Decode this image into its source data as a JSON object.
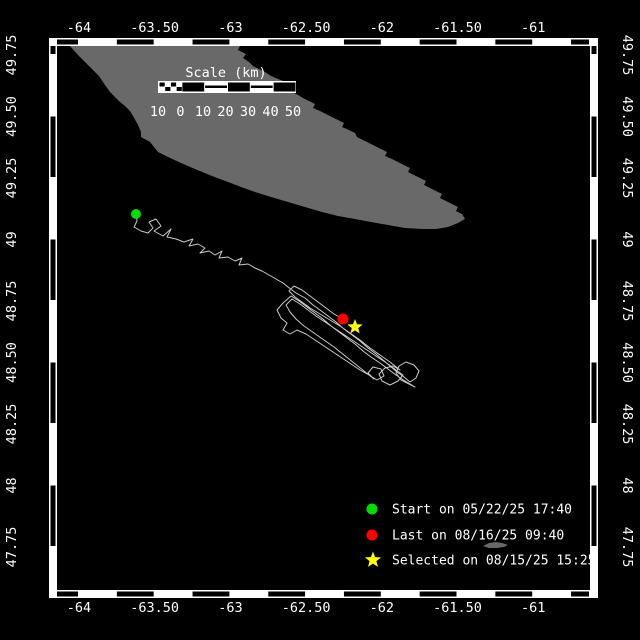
{
  "map": {
    "axes": {
      "lon_ticks": [
        "-64",
        "-63.50",
        "-63",
        "-62.50",
        "-62",
        "-61.50",
        "-61"
      ],
      "lat_ticks": [
        "49.75",
        "49.50",
        "49.25",
        "49",
        "48.75",
        "48.50",
        "48.25",
        "48",
        "47.75"
      ]
    },
    "scale_bar": {
      "title": "Scale (km)",
      "tick_labels": [
        "10",
        "0",
        "10",
        "20",
        "30",
        "40",
        "50"
      ]
    },
    "legend": [
      {
        "marker": "circle",
        "color": "#00dd00",
        "label": "Start on 05/22/25 17:40"
      },
      {
        "marker": "circle",
        "color": "#ff0000",
        "label": "Last on 08/16/25 09:40"
      },
      {
        "marker": "star",
        "color": "#ffff00",
        "label": "Selected on 08/15/25 15:25"
      }
    ],
    "markers": {
      "start": {
        "x": 136,
        "y": 214,
        "color": "#00dd00"
      },
      "last": {
        "x": 343,
        "y": 319,
        "color": "#ff0000"
      },
      "selected": {
        "x": 355,
        "y": 327,
        "color": "#ffff00"
      }
    },
    "colors": {
      "background": "#000000",
      "land": "#696969",
      "track": "#c9c9c9",
      "frame": "#ffffff",
      "text": "#ffffff"
    },
    "land_polygons": [
      [
        [
          70,
          46
        ],
        [
          78,
          55
        ],
        [
          85,
          62
        ],
        [
          92,
          69
        ],
        [
          99,
          76
        ],
        [
          105,
          85
        ],
        [
          110,
          92
        ],
        [
          115,
          97
        ],
        [
          120,
          102
        ],
        [
          125,
          106
        ],
        [
          130,
          111
        ],
        [
          133,
          116
        ],
        [
          138,
          125
        ],
        [
          141,
          132
        ],
        [
          141,
          137
        ],
        [
          150,
          142
        ],
        [
          154,
          147
        ],
        [
          158,
          152
        ],
        [
          168,
          157
        ],
        [
          181,
          163
        ],
        [
          195,
          169
        ],
        [
          212,
          176
        ],
        [
          228,
          182
        ],
        [
          241,
          187
        ],
        [
          255,
          192
        ],
        [
          271,
          197
        ],
        [
          288,
          202
        ],
        [
          305,
          207
        ],
        [
          322,
          212
        ],
        [
          338,
          216
        ],
        [
          355,
          219
        ],
        [
          371,
          222
        ],
        [
          388,
          225
        ],
        [
          405,
          228
        ],
        [
          422,
          229
        ],
        [
          436,
          229
        ],
        [
          448,
          227
        ],
        [
          458,
          223
        ],
        [
          465,
          219
        ],
        [
          462,
          214
        ],
        [
          456,
          211
        ],
        [
          458,
          207
        ],
        [
          452,
          204
        ],
        [
          446,
          201
        ],
        [
          440,
          198
        ],
        [
          442,
          194
        ],
        [
          436,
          191
        ],
        [
          430,
          188
        ],
        [
          424,
          185
        ],
        [
          426,
          181
        ],
        [
          420,
          178
        ],
        [
          414,
          175
        ],
        [
          408,
          172
        ],
        [
          410,
          168
        ],
        [
          404,
          165
        ],
        [
          398,
          162
        ],
        [
          392,
          159
        ],
        [
          385,
          156
        ],
        [
          387,
          152
        ],
        [
          381,
          149
        ],
        [
          375,
          146
        ],
        [
          369,
          143
        ],
        [
          363,
          140
        ],
        [
          357,
          137
        ],
        [
          355,
          133
        ],
        [
          349,
          130
        ],
        [
          342,
          127
        ],
        [
          344,
          123
        ],
        [
          338,
          120
        ],
        [
          332,
          117
        ],
        [
          326,
          114
        ],
        [
          320,
          111
        ],
        [
          313,
          108
        ],
        [
          315,
          104
        ],
        [
          309,
          101
        ],
        [
          303,
          98
        ],
        [
          298,
          95
        ],
        [
          292,
          92
        ],
        [
          286,
          89
        ],
        [
          280,
          85
        ],
        [
          286,
          82
        ],
        [
          278,
          79
        ],
        [
          271,
          76
        ],
        [
          265,
          72
        ],
        [
          259,
          69
        ],
        [
          253,
          66
        ],
        [
          249,
          62
        ],
        [
          243,
          58
        ],
        [
          246,
          54
        ],
        [
          238,
          50
        ],
        [
          240,
          46
        ]
      ],
      [
        [
          483,
          546
        ],
        [
          489,
          543
        ],
        [
          496,
          542
        ],
        [
          502,
          543
        ],
        [
          508,
          545
        ],
        [
          504,
          547
        ],
        [
          497,
          548
        ],
        [
          489,
          548
        ]
      ]
    ],
    "track": [
      [
        136,
        214
      ],
      [
        137,
        221
      ],
      [
        134,
        227
      ],
      [
        141,
        231
      ],
      [
        148,
        233
      ],
      [
        153,
        228
      ],
      [
        149,
        222
      ],
      [
        156,
        219
      ],
      [
        161,
        226
      ],
      [
        154,
        231
      ],
      [
        163,
        236
      ],
      [
        171,
        229
      ],
      [
        167,
        237
      ],
      [
        176,
        239
      ],
      [
        184,
        242
      ],
      [
        193,
        239
      ],
      [
        189,
        246
      ],
      [
        198,
        244
      ],
      [
        205,
        248
      ],
      [
        200,
        253
      ],
      [
        209,
        251
      ],
      [
        215,
        255
      ],
      [
        222,
        251
      ],
      [
        219,
        258
      ],
      [
        228,
        257
      ],
      [
        235,
        261
      ],
      [
        242,
        258
      ],
      [
        239,
        265
      ],
      [
        248,
        264
      ],
      [
        255,
        268
      ],
      [
        262,
        271
      ],
      [
        269,
        275
      ],
      [
        276,
        279
      ],
      [
        283,
        283
      ],
      [
        288,
        287
      ],
      [
        296,
        293
      ],
      [
        305,
        298
      ],
      [
        313,
        305
      ],
      [
        320,
        310
      ],
      [
        328,
        316
      ],
      [
        336,
        322
      ],
      [
        344,
        329
      ],
      [
        352,
        335
      ],
      [
        360,
        341
      ],
      [
        368,
        348
      ],
      [
        376,
        354
      ],
      [
        383,
        360
      ],
      [
        390,
        366
      ],
      [
        397,
        372
      ],
      [
        404,
        377
      ],
      [
        410,
        382
      ],
      [
        416,
        378
      ],
      [
        419,
        371
      ],
      [
        414,
        365
      ],
      [
        406,
        362
      ],
      [
        399,
        366
      ],
      [
        396,
        373
      ],
      [
        401,
        380
      ],
      [
        409,
        384
      ],
      [
        415,
        387
      ],
      [
        405,
        381
      ],
      [
        396,
        375
      ],
      [
        388,
        369
      ],
      [
        380,
        363
      ],
      [
        371,
        357
      ],
      [
        363,
        351
      ],
      [
        355,
        344
      ],
      [
        347,
        338
      ],
      [
        339,
        332
      ],
      [
        331,
        326
      ],
      [
        323,
        319
      ],
      [
        315,
        313
      ],
      [
        307,
        307
      ],
      [
        299,
        301
      ],
      [
        291,
        296
      ],
      [
        283,
        303
      ],
      [
        277,
        310
      ],
      [
        281,
        318
      ],
      [
        287,
        323
      ],
      [
        283,
        330
      ],
      [
        290,
        334
      ],
      [
        297,
        330
      ],
      [
        306,
        334
      ],
      [
        315,
        340
      ],
      [
        324,
        346
      ],
      [
        333,
        352
      ],
      [
        342,
        358
      ],
      [
        351,
        364
      ],
      [
        360,
        370
      ],
      [
        369,
        375
      ],
      [
        377,
        380
      ],
      [
        384,
        376
      ],
      [
        381,
        369
      ],
      [
        373,
        367
      ],
      [
        368,
        373
      ],
      [
        374,
        379
      ],
      [
        364,
        371
      ],
      [
        354,
        363
      ],
      [
        344,
        355
      ],
      [
        334,
        347
      ],
      [
        324,
        340
      ],
      [
        314,
        333
      ],
      [
        304,
        326
      ],
      [
        296,
        319
      ],
      [
        290,
        312
      ],
      [
        286,
        305
      ],
      [
        292,
        299
      ],
      [
        300,
        304
      ],
      [
        308,
        310
      ],
      [
        316,
        316
      ],
      [
        325,
        322
      ],
      [
        334,
        328
      ],
      [
        343,
        334
      ],
      [
        352,
        340
      ],
      [
        361,
        346
      ],
      [
        370,
        352
      ],
      [
        379,
        358
      ],
      [
        388,
        364
      ],
      [
        396,
        370
      ],
      [
        403,
        375
      ],
      [
        398,
        381
      ],
      [
        390,
        385
      ],
      [
        382,
        381
      ],
      [
        379,
        374
      ],
      [
        385,
        368
      ],
      [
        393,
        366
      ],
      [
        400,
        370
      ],
      [
        390,
        362
      ],
      [
        380,
        355
      ],
      [
        370,
        348
      ],
      [
        360,
        340
      ],
      [
        350,
        333
      ],
      [
        340,
        326
      ],
      [
        330,
        320
      ],
      [
        320,
        314
      ],
      [
        310,
        308
      ],
      [
        302,
        302
      ],
      [
        295,
        297
      ],
      [
        289,
        291
      ],
      [
        294,
        286
      ],
      [
        302,
        290
      ],
      [
        310,
        296
      ],
      [
        318,
        302
      ],
      [
        326,
        308
      ],
      [
        334,
        314
      ],
      [
        343,
        319
      ]
    ]
  }
}
